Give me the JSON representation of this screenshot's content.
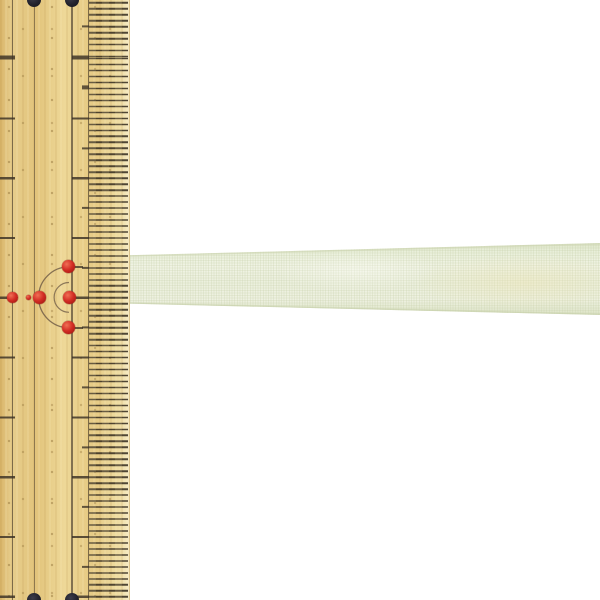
{
  "scene": {
    "description": "Product photograph: a pale yellow-green sheer organza ribbon lying horizontally across a white background, its width shown against a wooden bamboo ruler on the left",
    "background_color": "#ffffff",
    "image_size": "600x600"
  },
  "ruler": {
    "label": "bamboo-ruler",
    "wood_base_color": "#e6c883",
    "wood_light_color": "#f5e9c2",
    "mark_color": "#46392a",
    "right_edge_x_px": 129,
    "scale": {
      "cm_tick_spacing_px": 59.8,
      "halfcm_tick_spacing_px": 29.9,
      "mm_tick_spacing_px": 5.98,
      "mm_band_x_range_px": "89-127"
    },
    "corner_holes": {
      "label": "string-holes",
      "color": "#22222c",
      "count": 4,
      "positions": "two at top edge, two at bottom edge"
    },
    "red_marks": {
      "label": "red-center-markers",
      "color": "#d22c24",
      "dot_count": 6,
      "arc_count": 2,
      "arc_color": "#6b5844",
      "layout": "one dot above, three dots plus one tiny dot in a middle row, one dot below, with two concentric half-circle arcs opening left"
    }
  },
  "ribbon": {
    "label": "organza-ribbon",
    "base_color": "#edf1e0",
    "edge_color": "#cbd3ac",
    "sheen_color": "#eee4b2",
    "orientation": "horizontal",
    "extent": "from ruler right edge to right edge of image, slightly wider at right"
  }
}
